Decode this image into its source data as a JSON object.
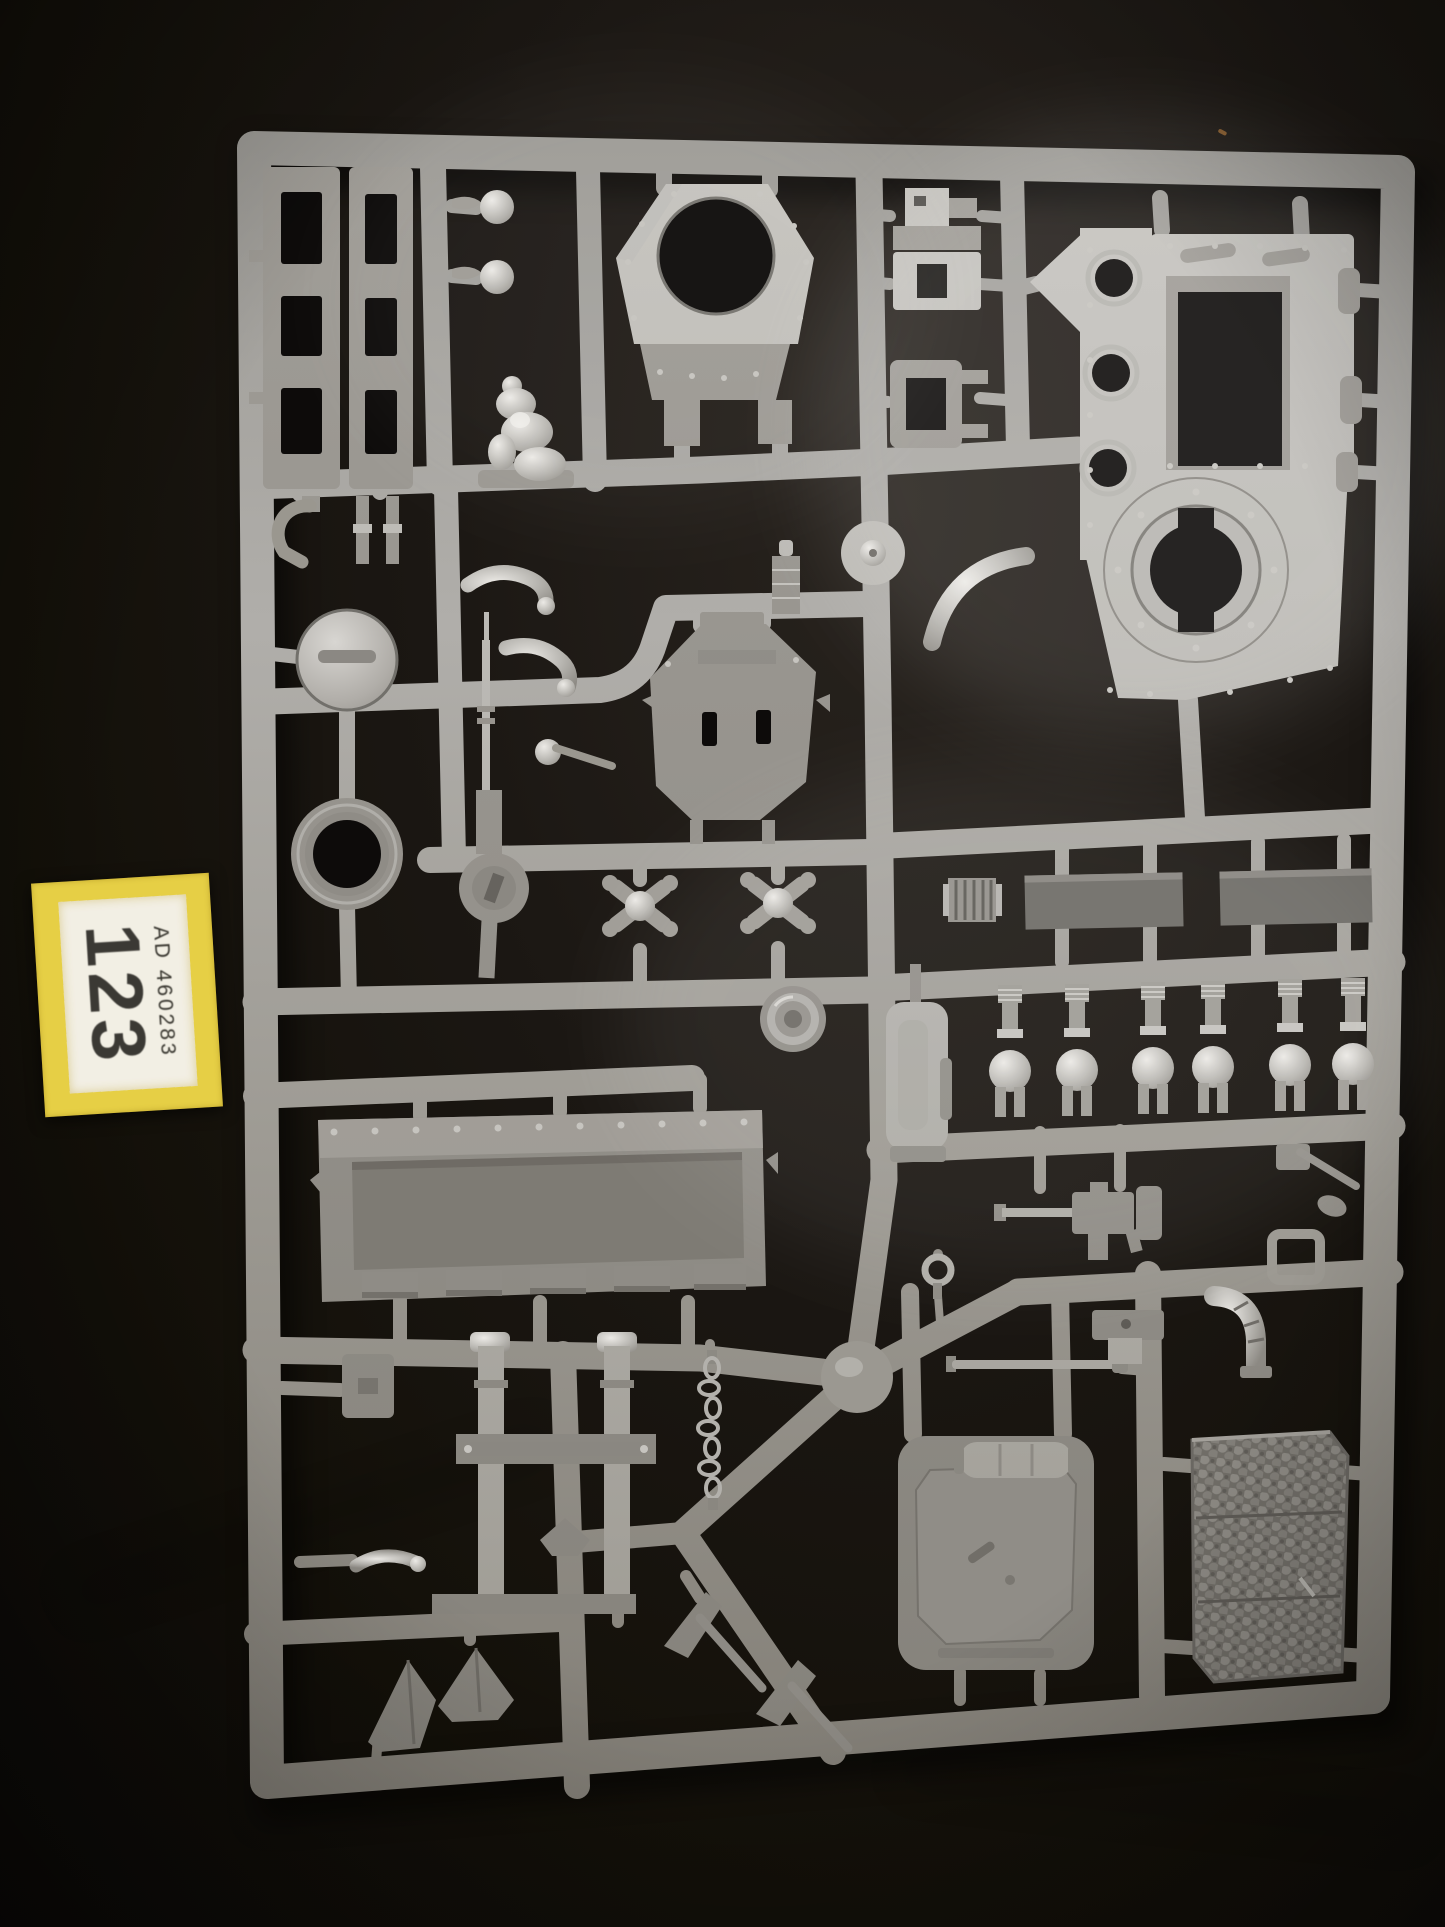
{
  "photo": {
    "subject": "grey plastic model kit sprue photographed on black fabric",
    "sticker": {
      "line1": "AD 460283",
      "line2": "123"
    },
    "colors": {
      "background": "#120f0d",
      "background_highlight": "#28231e",
      "sprue_light": "#c6c4bf",
      "sprue_mid": "#97948e",
      "sprue_dark": "#827e76",
      "part_dark": "#6f6d68",
      "hole_dark": "#0d0b0a",
      "metal_highlight": "#eceae6",
      "sticker_yellow": "#e6cf45",
      "sticker_paper": "#f2efe4",
      "sticker_text": "#38362f"
    },
    "scene": {
      "parts": [
        {
          "name": "ladder-rail",
          "count": 2
        },
        {
          "name": "turret-ring-plate",
          "count": 1
        },
        {
          "name": "hull-side-panel",
          "count": 1
        },
        {
          "name": "vision-block",
          "count": 3
        },
        {
          "name": "dome-hatch",
          "count": 1
        },
        {
          "name": "tyre-ring",
          "count": 1
        },
        {
          "name": "crew-figure",
          "count": 1
        },
        {
          "name": "long-rifle",
          "count": 1
        },
        {
          "name": "hexagonal-plate",
          "count": 1
        },
        {
          "name": "suspension-spring",
          "count": 6
        },
        {
          "name": "track-guard-strip",
          "count": 2
        },
        {
          "name": "engine-cylinder",
          "count": 1
        },
        {
          "name": "headlight-lens",
          "count": 1
        },
        {
          "name": "riveted-ramp-panel",
          "count": 1
        },
        {
          "name": "chain",
          "count": 1
        },
        {
          "name": "heavy-stubber",
          "count": 1
        },
        {
          "name": "exhaust-elbow",
          "count": 1
        },
        {
          "name": "access-door",
          "count": 1
        },
        {
          "name": "mesh-panel",
          "count": 1
        },
        {
          "name": "lifting-frame",
          "count": 1
        },
        {
          "name": "mining-pick",
          "count": 2
        },
        {
          "name": "tow-ring",
          "count": 1
        }
      ]
    }
  }
}
